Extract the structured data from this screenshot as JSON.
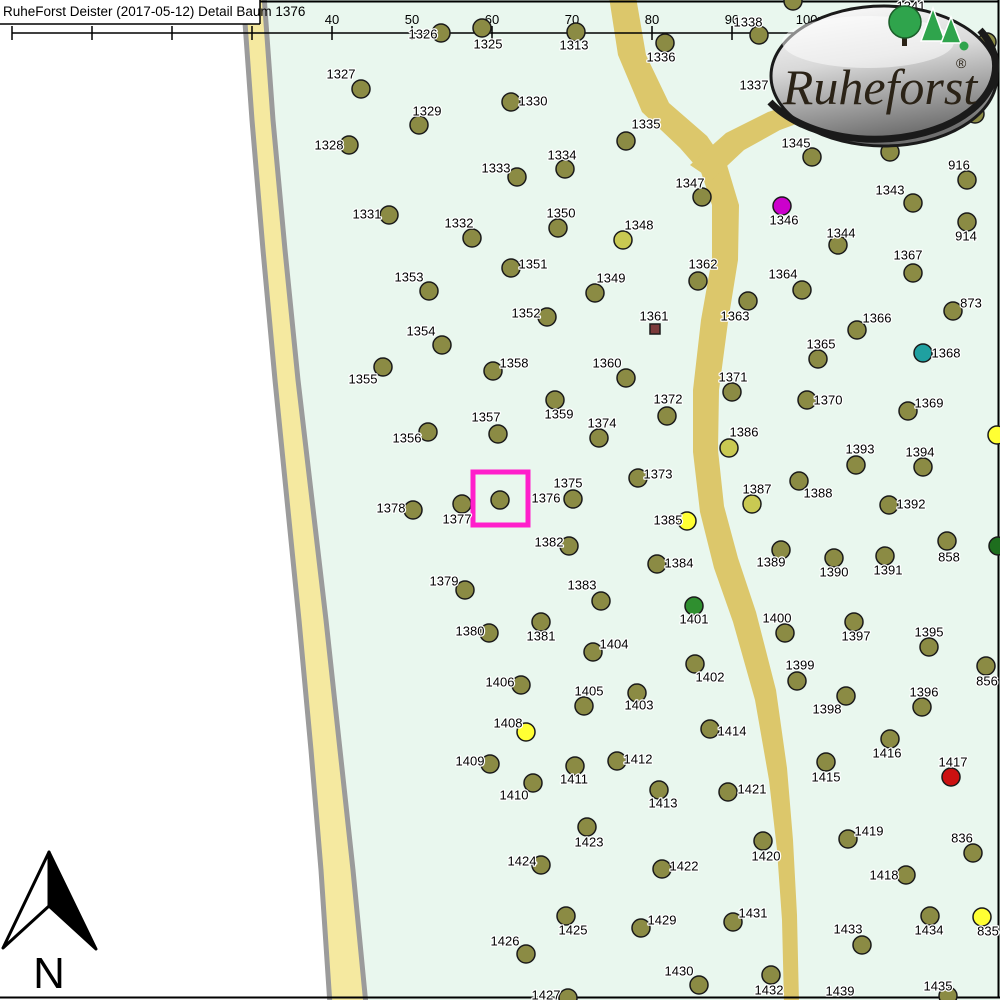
{
  "header": {
    "title": "RuheForst Deister (2017-05-12) Detail  Baum 1376"
  },
  "scale_bar": {
    "labels": [
      "0",
      "10",
      "20",
      "30",
      "40",
      "50",
      "60",
      "70",
      "80",
      "90",
      "100m"
    ],
    "start_x": 12,
    "spacing": 80,
    "line_y": 33
  },
  "north": {
    "label": "N"
  },
  "logo": {
    "brand": "Ruheforst",
    "registered": "®"
  },
  "highlight": {
    "tree": "1376",
    "x": 473,
    "y": 472,
    "w": 55,
    "h": 53,
    "color": "#FF1FCB"
  },
  "colors": {
    "olive": "#8B8B44",
    "dull": "#C9C952",
    "bright": "#FFFF33",
    "magenta": "#CC00CC",
    "teal": "#1FA0A0",
    "green": "#2F8F2F",
    "dgreen": "#1E6E1E",
    "red": "#CC1111",
    "brown": "#7B3A3A"
  },
  "trees": [
    {
      "l": "1313",
      "d": [
        576,
        32
      ],
      "t": [
        574,
        45
      ]
    },
    {
      "l": "1325",
      "d": [
        482,
        28
      ],
      "t": [
        488,
        44
      ]
    },
    {
      "l": "1326",
      "d": [
        441,
        33
      ],
      "t": [
        423,
        34
      ]
    },
    {
      "l": "1327",
      "d": [
        361,
        89
      ],
      "t": [
        341,
        74
      ]
    },
    {
      "l": "1328",
      "d": [
        349,
        145
      ],
      "t": [
        329,
        145
      ]
    },
    {
      "l": "1329",
      "d": [
        419,
        125
      ],
      "t": [
        427,
        111
      ]
    },
    {
      "l": "1330",
      "d": [
        511,
        102
      ],
      "t": [
        533,
        101
      ]
    },
    {
      "l": "1331",
      "d": [
        389,
        215
      ],
      "t": [
        367,
        214
      ]
    },
    {
      "l": "1332",
      "d": [
        472,
        238
      ],
      "t": [
        459,
        223
      ]
    },
    {
      "l": "1333",
      "d": [
        517,
        177
      ],
      "t": [
        496,
        168
      ]
    },
    {
      "l": "1334",
      "d": [
        565,
        169
      ],
      "t": [
        562,
        155
      ]
    },
    {
      "l": "1335",
      "d": [
        626,
        141
      ],
      "t": [
        646,
        124
      ]
    },
    {
      "l": "1336",
      "d": [
        665,
        43
      ],
      "t": [
        661,
        57
      ]
    },
    {
      "l": "1337",
      "d": null,
      "t": [
        754,
        85
      ]
    },
    {
      "l": "1338",
      "d": [
        759,
        35
      ],
      "t": [
        748,
        22
      ]
    },
    {
      "l": "1341",
      "d": null,
      "t": [
        911,
        6
      ]
    },
    {
      "l": "1343",
      "d": [
        913,
        203
      ],
      "t": [
        890,
        190
      ]
    },
    {
      "l": "1344",
      "d": [
        838,
        245
      ],
      "t": [
        841,
        233
      ]
    },
    {
      "l": "1345",
      "d": [
        812,
        157
      ],
      "t": [
        796,
        143
      ]
    },
    {
      "l": "1346",
      "d": [
        782,
        206
      ],
      "t": [
        784,
        220
      ],
      "c": "magenta"
    },
    {
      "l": "1347",
      "d": [
        702,
        197
      ],
      "t": [
        690,
        183
      ]
    },
    {
      "l": "1348",
      "d": [
        623,
        240
      ],
      "t": [
        639,
        225
      ],
      "c": "dull"
    },
    {
      "l": "1349",
      "d": [
        595,
        293
      ],
      "t": [
        611,
        278
      ]
    },
    {
      "l": "1350",
      "d": [
        558,
        228
      ],
      "t": [
        561,
        213
      ]
    },
    {
      "l": "1351",
      "d": [
        511,
        268
      ],
      "t": [
        533,
        264
      ]
    },
    {
      "l": "1352",
      "d": [
        547,
        317
      ],
      "t": [
        526,
        313
      ]
    },
    {
      "l": "1353",
      "d": [
        429,
        291
      ],
      "t": [
        409,
        277
      ]
    },
    {
      "l": "1354",
      "d": [
        442,
        345
      ],
      "t": [
        421,
        331
      ]
    },
    {
      "l": "1355",
      "d": [
        383,
        367
      ],
      "t": [
        363,
        379
      ]
    },
    {
      "l": "1356",
      "d": [
        428,
        432
      ],
      "t": [
        407,
        438
      ]
    },
    {
      "l": "1357",
      "d": [
        498,
        434
      ],
      "t": [
        486,
        417
      ]
    },
    {
      "l": "1358",
      "d": [
        493,
        371
      ],
      "t": [
        514,
        363
      ]
    },
    {
      "l": "1359",
      "d": [
        555,
        400
      ],
      "t": [
        559,
        414
      ]
    },
    {
      "l": "1360",
      "d": [
        626,
        378
      ],
      "t": [
        607,
        363
      ]
    },
    {
      "l": "1361",
      "d": [
        655,
        329
      ],
      "t": [
        654,
        316
      ],
      "c": "brown",
      "s": "square"
    },
    {
      "l": "1362",
      "d": [
        698,
        281
      ],
      "t": [
        703,
        264
      ]
    },
    {
      "l": "1363",
      "d": [
        748,
        301
      ],
      "t": [
        735,
        316
      ]
    },
    {
      "l": "1364",
      "d": [
        802,
        290
      ],
      "t": [
        783,
        274
      ]
    },
    {
      "l": "1365",
      "d": [
        818,
        359
      ],
      "t": [
        821,
        344
      ]
    },
    {
      "l": "1366",
      "d": [
        857,
        330
      ],
      "t": [
        877,
        318
      ]
    },
    {
      "l": "1367",
      "d": [
        913,
        273
      ],
      "t": [
        908,
        255
      ]
    },
    {
      "l": "1368",
      "d": [
        923,
        353
      ],
      "t": [
        946,
        353
      ],
      "c": "teal"
    },
    {
      "l": "1369",
      "d": [
        908,
        411
      ],
      "t": [
        929,
        403
      ]
    },
    {
      "l": "1370",
      "d": [
        807,
        400
      ],
      "t": [
        828,
        400
      ]
    },
    {
      "l": "1371",
      "d": [
        732,
        392
      ],
      "t": [
        733,
        377
      ]
    },
    {
      "l": "1372",
      "d": [
        667,
        416
      ],
      "t": [
        668,
        399
      ]
    },
    {
      "l": "1373",
      "d": [
        638,
        478
      ],
      "t": [
        658,
        474
      ]
    },
    {
      "l": "1374",
      "d": [
        599,
        438
      ],
      "t": [
        602,
        423
      ]
    },
    {
      "l": "1375",
      "d": [
        573,
        499
      ],
      "t": [
        568,
        483
      ]
    },
    {
      "l": "1376",
      "d": [
        500,
        500
      ],
      "t": [
        546,
        498
      ]
    },
    {
      "l": "1377",
      "d": [
        462,
        504
      ],
      "t": [
        457,
        519
      ]
    },
    {
      "l": "1378",
      "d": [
        413,
        510
      ],
      "t": [
        391,
        508
      ]
    },
    {
      "l": "1379",
      "d": [
        465,
        590
      ],
      "t": [
        444,
        581
      ]
    },
    {
      "l": "1380",
      "d": [
        489,
        633
      ],
      "t": [
        470,
        631
      ]
    },
    {
      "l": "1381",
      "d": [
        541,
        622
      ],
      "t": [
        541,
        636
      ]
    },
    {
      "l": "1382",
      "d": [
        569,
        546
      ],
      "t": [
        549,
        542
      ]
    },
    {
      "l": "1383",
      "d": [
        601,
        601
      ],
      "t": [
        582,
        585
      ]
    },
    {
      "l": "1384",
      "d": [
        657,
        564
      ],
      "t": [
        679,
        563
      ]
    },
    {
      "l": "1385",
      "d": [
        687,
        521
      ],
      "t": [
        668,
        520
      ],
      "c": "bright"
    },
    {
      "l": "1386",
      "d": [
        729,
        448
      ],
      "t": [
        744,
        432
      ],
      "c": "dull"
    },
    {
      "l": "1387",
      "d": [
        752,
        504
      ],
      "t": [
        757,
        489
      ],
      "c": "dull"
    },
    {
      "l": "1388",
      "d": [
        799,
        481
      ],
      "t": [
        818,
        493
      ]
    },
    {
      "l": "1389",
      "d": [
        781,
        550
      ],
      "t": [
        771,
        562
      ]
    },
    {
      "l": "1390",
      "d": [
        834,
        558
      ],
      "t": [
        834,
        572
      ]
    },
    {
      "l": "1391",
      "d": [
        885,
        556
      ],
      "t": [
        888,
        570
      ]
    },
    {
      "l": "1392",
      "d": [
        889,
        505
      ],
      "t": [
        911,
        504
      ]
    },
    {
      "l": "1393",
      "d": [
        856,
        465
      ],
      "t": [
        860,
        449
      ]
    },
    {
      "l": "1394",
      "d": [
        923,
        467
      ],
      "t": [
        920,
        452
      ]
    },
    {
      "l": "1395",
      "d": [
        929,
        647
      ],
      "t": [
        929,
        632
      ]
    },
    {
      "l": "1396",
      "d": [
        922,
        707
      ],
      "t": [
        924,
        692
      ]
    },
    {
      "l": "1397",
      "d": [
        854,
        622
      ],
      "t": [
        856,
        636
      ]
    },
    {
      "l": "1398",
      "d": [
        846,
        696
      ],
      "t": [
        827,
        709
      ]
    },
    {
      "l": "1399",
      "d": [
        797,
        681
      ],
      "t": [
        800,
        665
      ]
    },
    {
      "l": "1400",
      "d": [
        785,
        633
      ],
      "t": [
        777,
        618
      ]
    },
    {
      "l": "1401",
      "d": [
        694,
        606
      ],
      "t": [
        694,
        619
      ],
      "c": "green"
    },
    {
      "l": "1402",
      "d": [
        695,
        664
      ],
      "t": [
        710,
        677
      ]
    },
    {
      "l": "1403",
      "d": [
        637,
        693
      ],
      "t": [
        639,
        705
      ]
    },
    {
      "l": "1404",
      "d": [
        593,
        652
      ],
      "t": [
        614,
        644
      ]
    },
    {
      "l": "1405",
      "d": [
        584,
        706
      ],
      "t": [
        589,
        691
      ]
    },
    {
      "l": "1406",
      "d": [
        521,
        685
      ],
      "t": [
        500,
        682
      ]
    },
    {
      "l": "1408",
      "d": [
        526,
        732
      ],
      "t": [
        508,
        723
      ],
      "c": "bright"
    },
    {
      "l": "1409",
      "d": [
        490,
        764
      ],
      "t": [
        470,
        761
      ]
    },
    {
      "l": "1410",
      "d": [
        533,
        783
      ],
      "t": [
        514,
        795
      ]
    },
    {
      "l": "1411",
      "d": [
        575,
        766
      ],
      "t": [
        574,
        779
      ]
    },
    {
      "l": "1412",
      "d": [
        617,
        761
      ],
      "t": [
        638,
        759
      ]
    },
    {
      "l": "1413",
      "d": [
        659,
        790
      ],
      "t": [
        663,
        803
      ]
    },
    {
      "l": "1414",
      "d": [
        710,
        729
      ],
      "t": [
        732,
        731
      ]
    },
    {
      "l": "1415",
      "d": [
        826,
        762
      ],
      "t": [
        826,
        777
      ]
    },
    {
      "l": "1416",
      "d": [
        890,
        739
      ],
      "t": [
        887,
        753
      ]
    },
    {
      "l": "1417",
      "d": [
        951,
        777
      ],
      "t": [
        953,
        762
      ],
      "c": "red"
    },
    {
      "l": "1418",
      "d": [
        906,
        875
      ],
      "t": [
        884,
        875
      ]
    },
    {
      "l": "1419",
      "d": [
        848,
        839
      ],
      "t": [
        869,
        831
      ]
    },
    {
      "l": "1420",
      "d": [
        763,
        841
      ],
      "t": [
        766,
        856
      ]
    },
    {
      "l": "1421",
      "d": [
        728,
        792
      ],
      "t": [
        752,
        789
      ]
    },
    {
      "l": "1422",
      "d": [
        662,
        869
      ],
      "t": [
        684,
        866
      ]
    },
    {
      "l": "1423",
      "d": [
        587,
        827
      ],
      "t": [
        589,
        842
      ]
    },
    {
      "l": "1424",
      "d": [
        541,
        865
      ],
      "t": [
        522,
        861
      ]
    },
    {
      "l": "1425",
      "d": [
        566,
        916
      ],
      "t": [
        573,
        930
      ]
    },
    {
      "l": "1426",
      "d": [
        526,
        954
      ],
      "t": [
        505,
        941
      ]
    },
    {
      "l": "1427",
      "d": [
        568,
        998
      ],
      "t": [
        546,
        995
      ]
    },
    {
      "l": "1429",
      "d": [
        641,
        928
      ],
      "t": [
        662,
        920
      ]
    },
    {
      "l": "1430",
      "d": [
        699,
        985
      ],
      "t": [
        679,
        971
      ]
    },
    {
      "l": "1431",
      "d": [
        733,
        922
      ],
      "t": [
        753,
        913
      ]
    },
    {
      "l": "1432",
      "d": [
        771,
        975
      ],
      "t": [
        769,
        990
      ]
    },
    {
      "l": "1433",
      "d": [
        862,
        945
      ],
      "t": [
        848,
        929
      ]
    },
    {
      "l": "1434",
      "d": [
        930,
        916
      ],
      "t": [
        929,
        930
      ]
    },
    {
      "l": "1435",
      "d": [
        948,
        996
      ],
      "t": [
        938,
        986
      ]
    },
    {
      "l": "1439",
      "d": null,
      "t": [
        840,
        991
      ]
    },
    {
      "l": "835",
      "d": [
        982,
        917
      ],
      "t": [
        988,
        931
      ],
      "c": "bright"
    },
    {
      "l": "836",
      "d": [
        973,
        853
      ],
      "t": [
        962,
        838
      ]
    },
    {
      "l": "856",
      "d": [
        986,
        666
      ],
      "t": [
        987,
        681
      ]
    },
    {
      "l": "858",
      "d": [
        947,
        541
      ],
      "t": [
        949,
        557
      ]
    },
    {
      "l": "873",
      "d": [
        953,
        311
      ],
      "t": [
        971,
        303
      ]
    },
    {
      "l": "914",
      "d": [
        967,
        222
      ],
      "t": [
        966,
        236
      ]
    },
    {
      "l": "916",
      "d": [
        967,
        180
      ],
      "t": [
        959,
        165
      ]
    },
    {
      "l": "",
      "d": [
        890,
        152
      ]
    },
    {
      "l": "",
      "d": [
        987,
        42
      ]
    },
    {
      "l": "",
      "d": [
        975,
        114
      ]
    },
    {
      "l": "",
      "d": [
        793,
        1
      ]
    },
    {
      "l": "",
      "d": [
        997,
        435
      ],
      "c": "bright"
    },
    {
      "l": "",
      "d": [
        998,
        546
      ],
      "c": "dgreen"
    }
  ]
}
